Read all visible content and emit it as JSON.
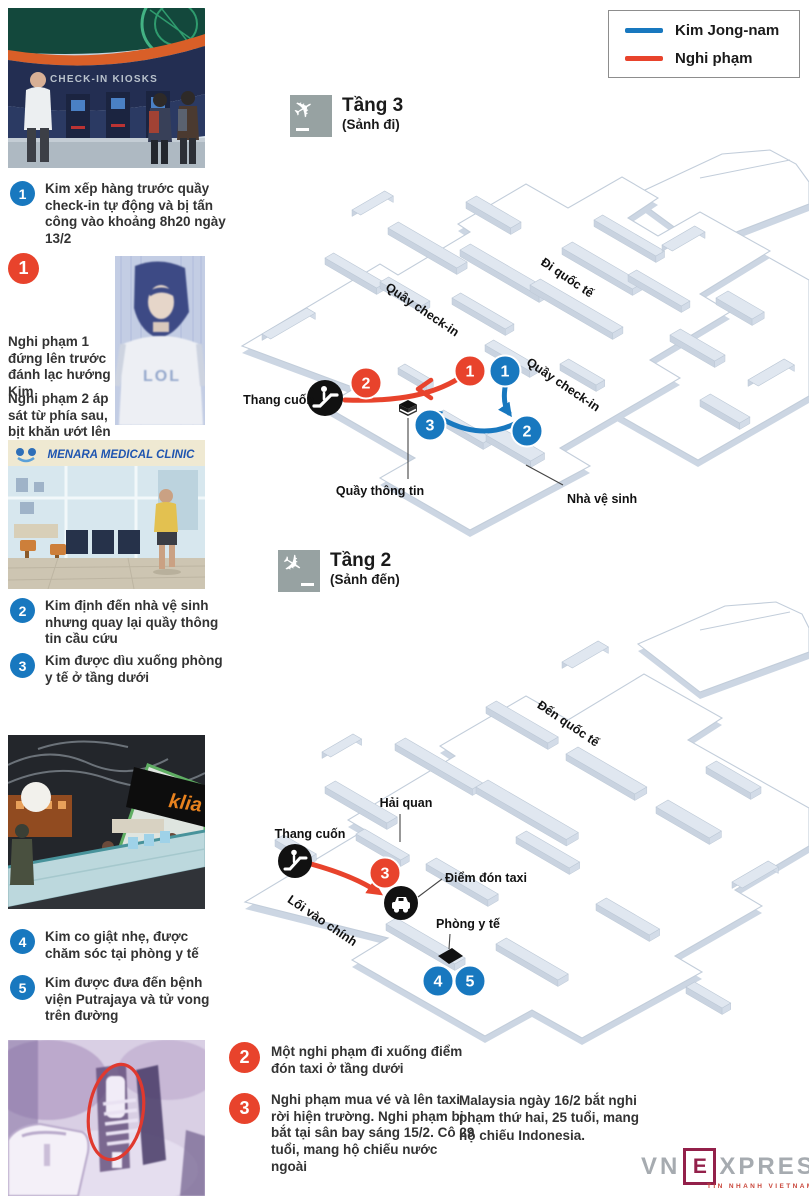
{
  "legend": {
    "items": [
      {
        "label": "Kim Jong-nam",
        "color": "#1878bf"
      },
      {
        "label": "Nghi phạm",
        "color": "#e8432c"
      }
    ]
  },
  "steps_kim": [
    {
      "num": "1",
      "text": "Kim xếp hàng trước quầy check-in tự động và bị tấn công vào khoảng 8h20 ngày 13/2"
    },
    {
      "num": "2",
      "text": "Kim định đến nhà vệ sinh nhưng quay lại quầy thông tin cầu cứu"
    },
    {
      "num": "3",
      "text": "Kim được dìu xuống phòng y tế ở tầng dưới"
    },
    {
      "num": "4",
      "text": "Kim co giật nhẹ, được chăm sóc tại phòng y tế"
    },
    {
      "num": "5",
      "text": "Kim được đưa đến bệnh viện Putrajaya và tử vong trên đường"
    }
  ],
  "suspect_side": {
    "num": "1",
    "lines": [
      "Nghi phạm 1 đứng lên trước đánh lạc hướng Kim",
      "Nghi phạm 2 áp sát từ phía sau, bịt khăn ướt lên mặt Kim"
    ]
  },
  "suspect_bottom": [
    {
      "num": "2",
      "text": "Một nghi phạm đi xuống điểm đón taxi ở tầng dưới"
    },
    {
      "num": "3",
      "text": "Nghi phạm mua vé và lên taxi rời hiện trường. Nghi phạm bị bắt tại sân bay sáng 15/2. Cô 29 tuổi, mang hộ chiếu nước ngoài"
    }
  ],
  "note": "Malaysia ngày 16/2 bắt nghi phạm thứ hai, 25 tuổi, mang hộ chiếu Indonesia.",
  "floor3": {
    "title": "Tầng 3",
    "subtitle": "(Sảnh đi)",
    "labels": {
      "checkin": "Quầy check-in",
      "intl": "Đi quốc tế",
      "escalator": "Thang cuốn",
      "info": "Quầy thông tin",
      "toilet": "Nhà vệ sinh"
    },
    "badges": {
      "sus1": "1",
      "sus2": "2",
      "kim1": "1",
      "kim2": "2",
      "kim3": "3"
    }
  },
  "floor2": {
    "title": "Tầng 2",
    "subtitle": "(Sảnh đến)",
    "labels": {
      "intl": "Đến quốc tế",
      "customs": "Hải quan",
      "escalator": "Thang cuốn",
      "taxi": "Điểm đón taxi",
      "entrance": "Lối vào chính",
      "medical": "Phòng y tế"
    },
    "badges": {
      "sus3": "3",
      "kim4": "4",
      "kim5": "5"
    }
  },
  "photos": {
    "checkin": {
      "sign": "CHECK-IN KIOSKS"
    },
    "suspect": {
      "shirt": "LOL"
    },
    "clinic": {
      "sign": "MENARA MEDICAL CLINIC"
    },
    "klia": {
      "sign": "klia"
    }
  },
  "logo": {
    "vn": "VN",
    "e": "E",
    "xpress": "XPRESS",
    "tagline": "TIN NHANH VIETNAM"
  }
}
